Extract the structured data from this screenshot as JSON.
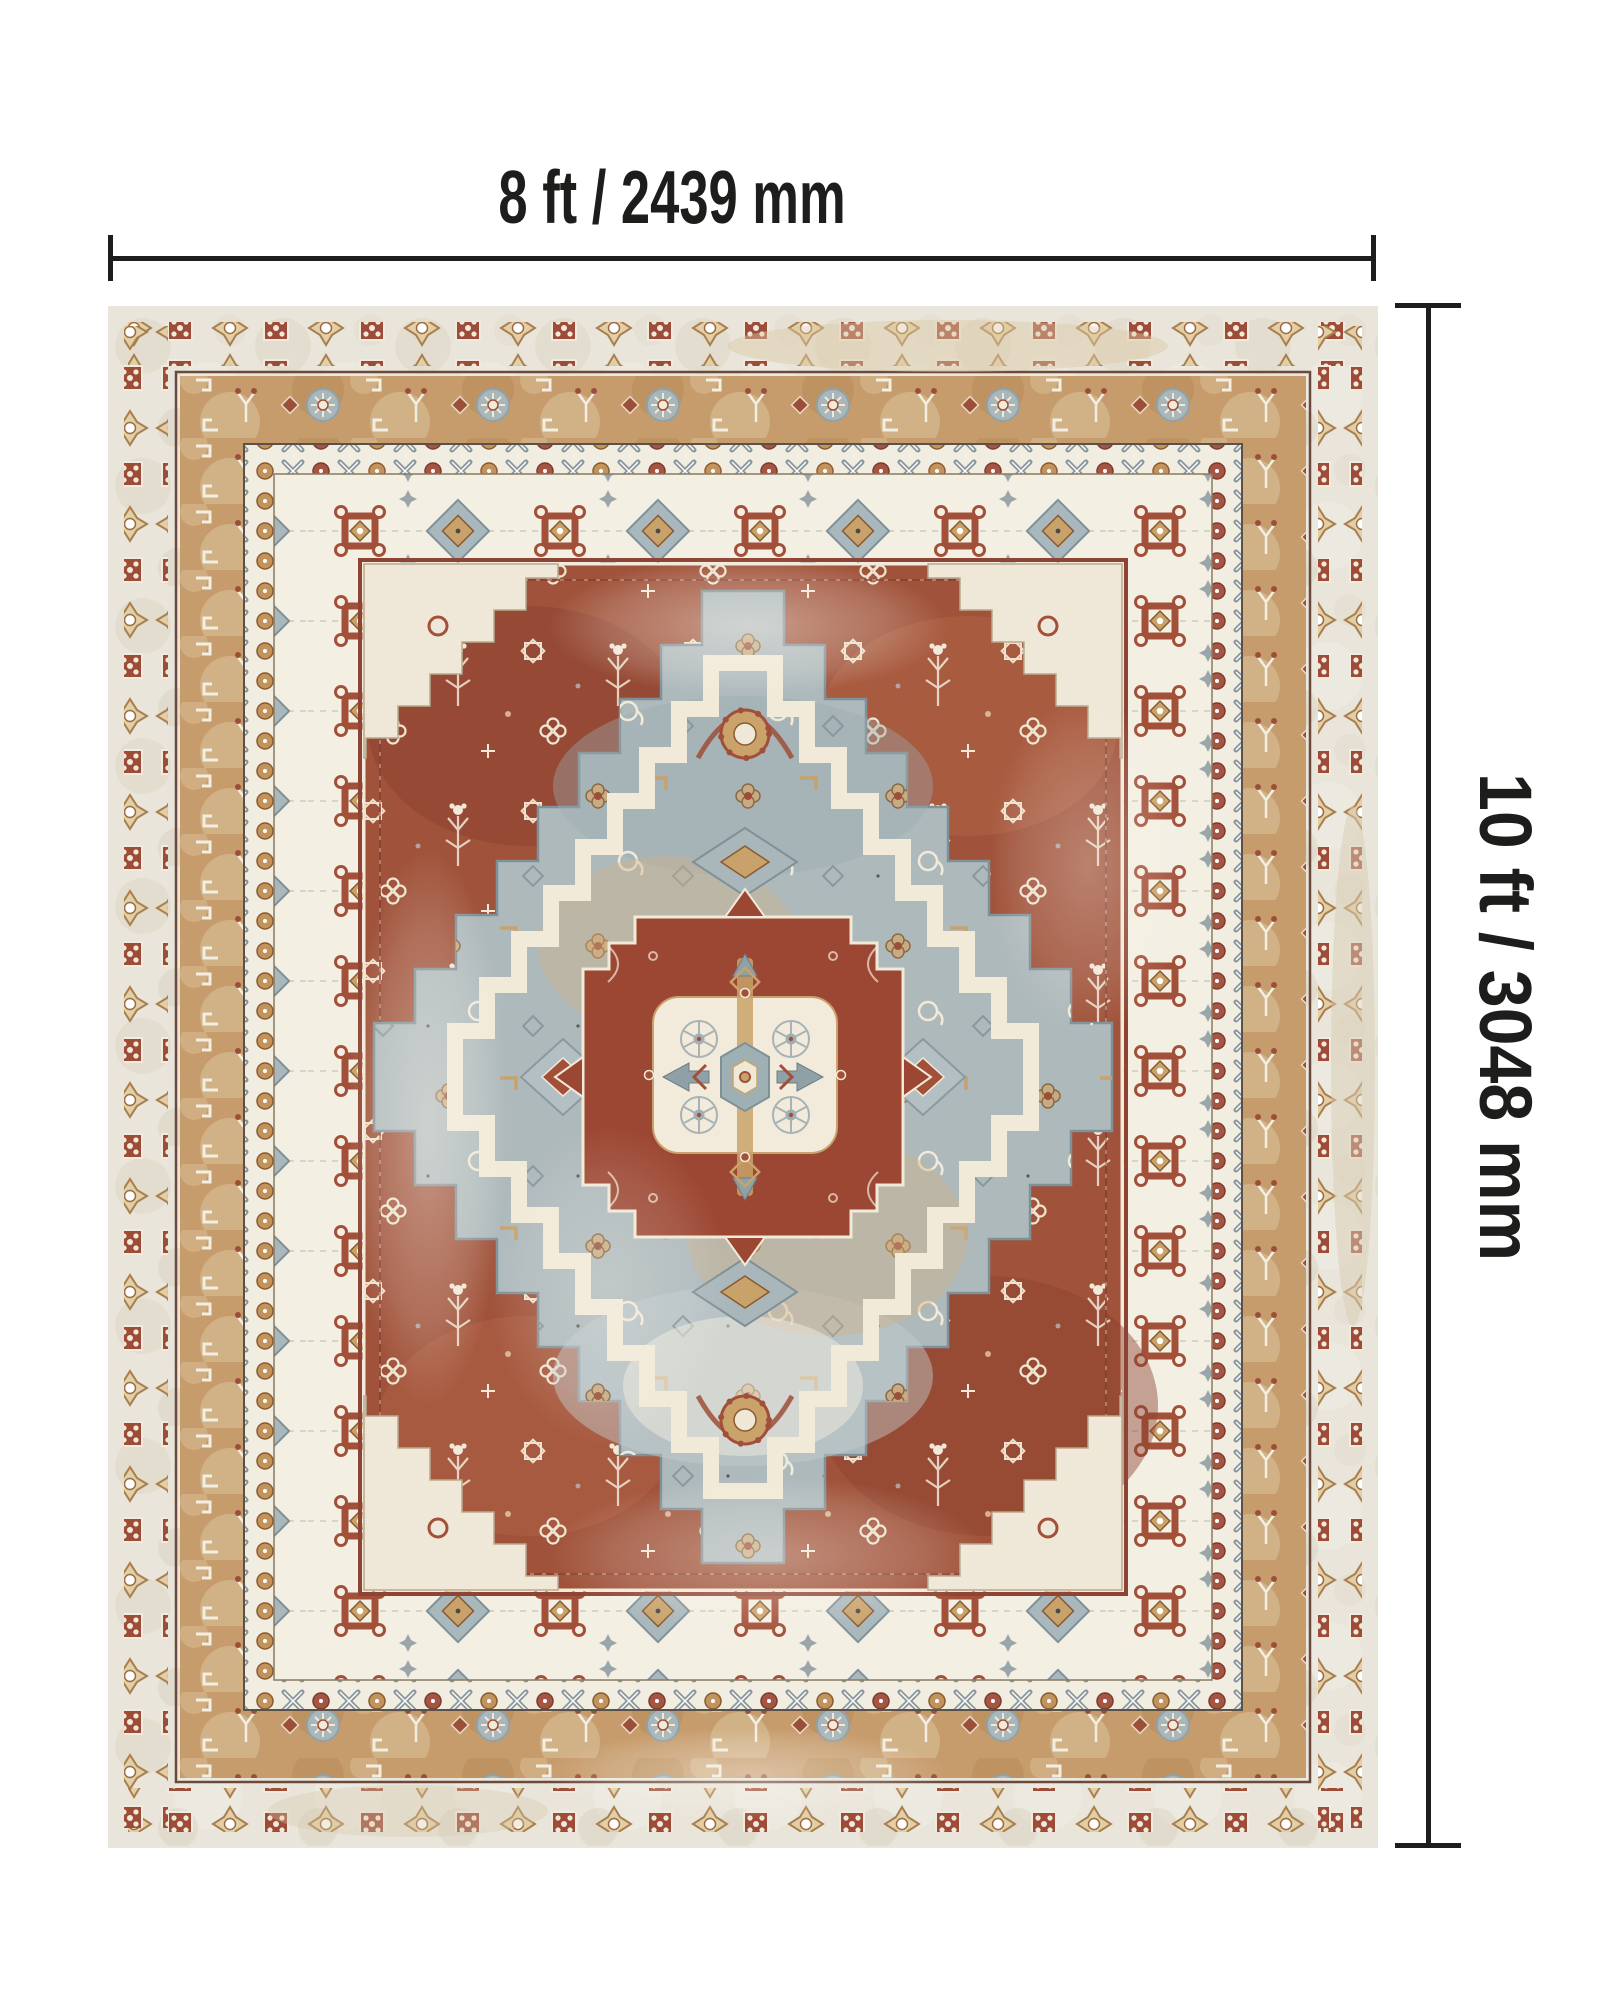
{
  "annotations": {
    "width": {
      "label": "8 ft / 2439 mm"
    },
    "height": {
      "label": "10 ft / 3048 mm"
    }
  },
  "rug": {
    "palette": {
      "background": "#ffffff",
      "annotation_black": "#1d1d1b",
      "margin_cream": "#e9e5da",
      "tan_band": "#c79c6d",
      "border_white": "#f4efe3",
      "field_rust": "#a0523a",
      "medallion_rust": "#9c4733",
      "blue_gray": "#aeb9bc",
      "inner_cream": "#e7d8ba",
      "accent_gold": "#c9a369",
      "accent_rust": "#a3503a"
    }
  }
}
